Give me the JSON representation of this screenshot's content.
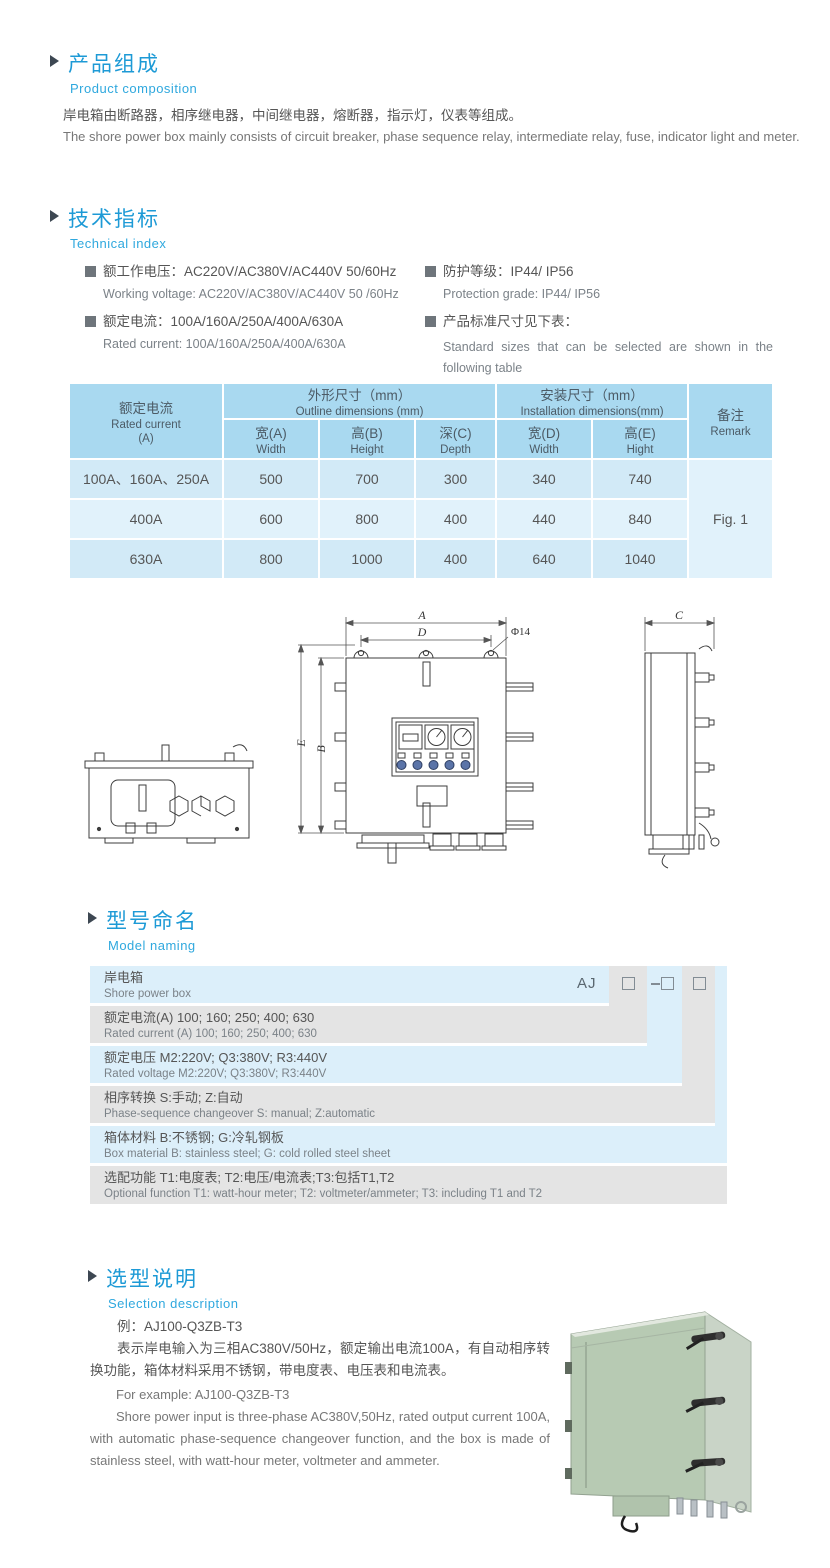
{
  "composition": {
    "title_zh": "产品组成",
    "title_en": "Product  composition",
    "body_zh": "岸电箱由断路器，相序继电器，中间继电器，熔断器，指示灯，仪表等组成。",
    "body_en": "The shore power box mainly consists of circuit breaker, phase sequence relay, intermediate relay, fuse, indicator light and meter."
  },
  "technical": {
    "title_zh": "技术指标",
    "title_en": "Technical index",
    "specs": [
      {
        "zh": "额工作电压：AC220V/AC380V/AC440V  50/60Hz",
        "en": "Working voltage: AC220V/AC380V/AC440V 50 /60Hz"
      },
      {
        "zh": "额定电流：100A/160A/250A/400A/630A",
        "en": "Rated current: 100A/160A/250A/400A/630A"
      },
      {
        "zh": "防护等级：IP44/ IP56",
        "en": "Protection grade: IP44/ IP56"
      },
      {
        "zh": "产品标准尺寸见下表：",
        "en": "Standard sizes that can be selected are shown in the following table"
      }
    ]
  },
  "dims_table": {
    "col_current_zh": "额定电流",
    "col_current_en": "Rated current",
    "col_current_unit": "(A)",
    "outline_zh": "外形尺寸（mm）",
    "outline_en": "Outline dimensions (mm)",
    "install_zh": "安装尺寸（mm）",
    "install_en": "Installation dimensions(mm)",
    "remark_zh": "备注",
    "remark_en": "Remark",
    "sub_headers": [
      {
        "zh": "宽(A)",
        "en": "Width"
      },
      {
        "zh": "高(B)",
        "en": "Height"
      },
      {
        "zh": "深(C)",
        "en": "Depth"
      },
      {
        "zh": "宽(D)",
        "en": "Width"
      },
      {
        "zh": "高(E)",
        "en": "Hight"
      }
    ],
    "rows": [
      {
        "current": "100A、160A、250A",
        "w": "500",
        "h": "700",
        "d": "300",
        "iw": "340",
        "ih": "740"
      },
      {
        "current": "400A",
        "w": "600",
        "h": "800",
        "d": "400",
        "iw": "440",
        "ih": "840"
      },
      {
        "current": "630A",
        "w": "800",
        "h": "1000",
        "d": "400",
        "iw": "640",
        "ih": "1040"
      }
    ],
    "remark_value": "Fig. 1"
  },
  "drawing": {
    "labels": {
      "a": "A",
      "d": "D",
      "phi": "Φ14",
      "b": "B",
      "e": "E",
      "c": "C"
    }
  },
  "model_naming": {
    "title_zh": "型号命名",
    "title_en": "Model naming",
    "code": {
      "prefix": "AJ",
      "placeholders": [
        "□",
        "-□",
        "□"
      ]
    },
    "rows": [
      {
        "zh": "岸电箱",
        "en": "Shore power box"
      },
      {
        "zh": "额定电流(A)  100; 160; 250; 400; 630",
        "en": "Rated current (A) 100; 160; 250; 400; 630"
      },
      {
        "zh": "额定电压   M2:220V;  Q3:380V;  R3:440V",
        "en": "Rated voltage  M2:220V;  Q3:380V;  R3:440V"
      },
      {
        "zh": "相序转换  S:手动; Z:自动",
        "en": "Phase-sequence changeover  S: manual;  Z:automatic"
      },
      {
        "zh": "箱体材料    B:不锈钢;  G:冷轧钢板",
        "en": "Box material   B: stainless steel; G: cold rolled steel sheet"
      },
      {
        "zh": "选配功能      T1:电度表; T2:电压/电流表;T3:包括T1,T2",
        "en": "Optional function  T1: watt-hour meter; T2: voltmeter/ammeter; T3: including T1 and T2"
      }
    ]
  },
  "selection": {
    "title_zh": "选型说明",
    "title_en": "Selection description",
    "example_zh": "例：AJ100-Q3ZB-T3",
    "desc_zh": "表示岸电输入为三相AC380V/50Hz，额定输出电流100A，有自动相序转换功能，箱体材料采用不锈钢，带电度表、电压表和电流表。",
    "example_en": "For example: AJ100-Q3ZB-T3",
    "desc_en": "Shore power input is three-phase AC380V,50Hz, rated output current 100A, with automatic phase-sequence changeover function, and the box is made of stainless steel, with watt-hour meter, voltmeter and ammeter."
  }
}
